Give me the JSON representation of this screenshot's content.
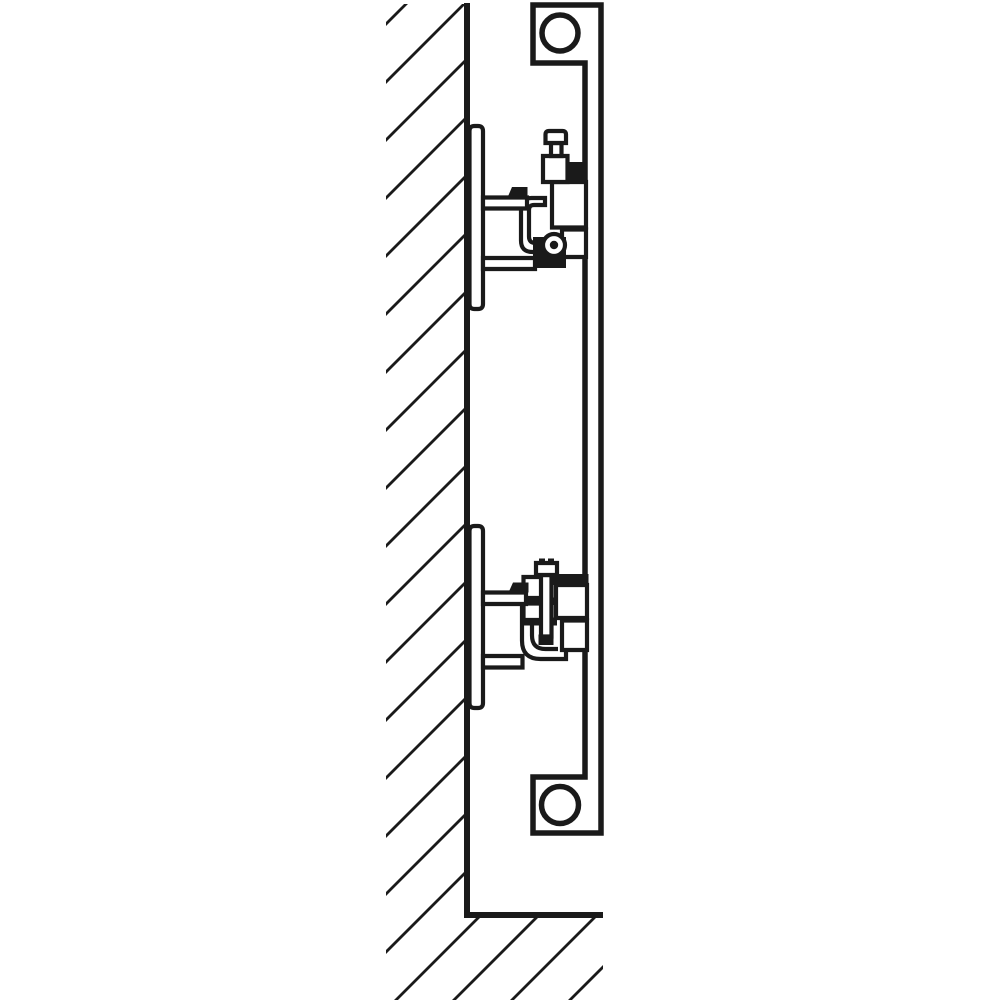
{
  "colors": {
    "line": "#1a1a1a",
    "background": "#ffffff"
  },
  "canvas": {
    "width": 1000,
    "height": 1000
  },
  "wall": {
    "border_d": "M467,3 L467,915 L603,915",
    "hatch_clip_d": "M386,4 L468,4 L468,912 L603,912 L603,1000 L386,1000 Z",
    "hatch_offsets": [
      410,
      468,
      526,
      584,
      642,
      700,
      758,
      816,
      874,
      932,
      990,
      1048,
      1106,
      1164,
      1222,
      1280,
      1338,
      1396,
      1454,
      1512,
      1570
    ]
  },
  "panel": {
    "outline_d": "M533,5 L601,5 L601,833 L533,833 L533,777 L585,777 L585,63 L533,63 Z",
    "top_circle": {
      "cx": 560,
      "cy": 33,
      "r": 18
    },
    "bottom_circle": {
      "cx": 560,
      "cy": 805,
      "r": 18.5
    }
  },
  "wall_plates": {
    "top_d": "M469.5,131 q0,-5 5,-5 h3.5 q5,0 5,5 v173 q0,5 -5,5 h-3.5 q-5,0 -5,-5 z",
    "bottom_d": "M469.5,531 q0,-5 5,-5 h3.5 q5,0 5,5 v172 q0,5 -5,5 h-3.5 q-5,0 -5,-5 z"
  },
  "bracket_top": {
    "connector_d": "M563,162 h23 v21 h-23 z",
    "lug_d": "M552,182 h34 v45.5 h-34 z",
    "block_d": "M562,229.5 h24 v27.5 h-24 z",
    "clamp_d": "M545,198 h-13.5 q-10.5,0 -10.5,10.5 v32 q0,11.5 11.5,11.5 h16.5 v-9 h-13.5 q-6.5,0 -6.5,-6.5 v-26.5 q0,-5 5,-5 h11 z",
    "foot_d": "M533,237 h33 v31 h-33 z",
    "arm_upper_d": "M483,197.5 h44 v11 h-44 z",
    "arm_lower_d": "M483,258 h52 v11 h-52 z",
    "column_d": "M543,156 h24.5 v26 h-24.5 z",
    "bolt_neck_d": "M551,143 h10.5 v13 h-10.5 z",
    "bolt_cap_d": "M545.5,143 v-8.5 q0,-3.5 3.5,-3.5 h13.5 q3.5,0 3.5,3.5 v8.5 z",
    "tab_d": "M507.5,197.5 l4.5,-10.5 h15.5 v10.5 z",
    "pivot": {
      "cx": 554,
      "cy": 245,
      "r": 11,
      "dot_r": 4.2
    }
  },
  "bracket_bottom": {
    "connector_d": "M553,574 h35.5 v11 h-35.5 z",
    "bar_top_d": "M523,597.5 h34 v7.5 h-34 z",
    "bar_mid_d": "M523,617.5 h34 v8 h-34 z",
    "hook_outer_d": "M522,601 v39.5 q0,18.5 18.5,18.5 h25.5 v-10.5",
    "hook_inner_d": "M532,601 v34.5 q0,13.5 13.5,13.5 h12.5",
    "finger_upper_d": "M523.5,577 h18 v21 h-18 z",
    "finger_lower_d": "M523.5,603.5 h18 v16.5 h-18 z",
    "lug_d": "M556,585 h31 v33 h-31 z",
    "block_d": "M562,620.5 h25 v29.5 h-25 z",
    "arm_upper_d": "M483,592.5 h43 v11.5 h-43 z",
    "arm_lower_d": "M483,656 h39.5 v11.5 h-39.5 z",
    "screw_d": "M541,575 h10.5 v61.5 h-10.5 z",
    "screw_tip_d": "M538.5,634.5 h15 v10.5 h-15 z",
    "cap_d": "M536,563 h21 v12 h-21 z",
    "nub1_d": "M539,558.5 h6 v5 h-6 z",
    "nub2_d": "M548,558.5 h6 v5 h-6 z",
    "tab_d": "M508.5,592.5 l4.5,-10 h15.5 v10 z"
  }
}
